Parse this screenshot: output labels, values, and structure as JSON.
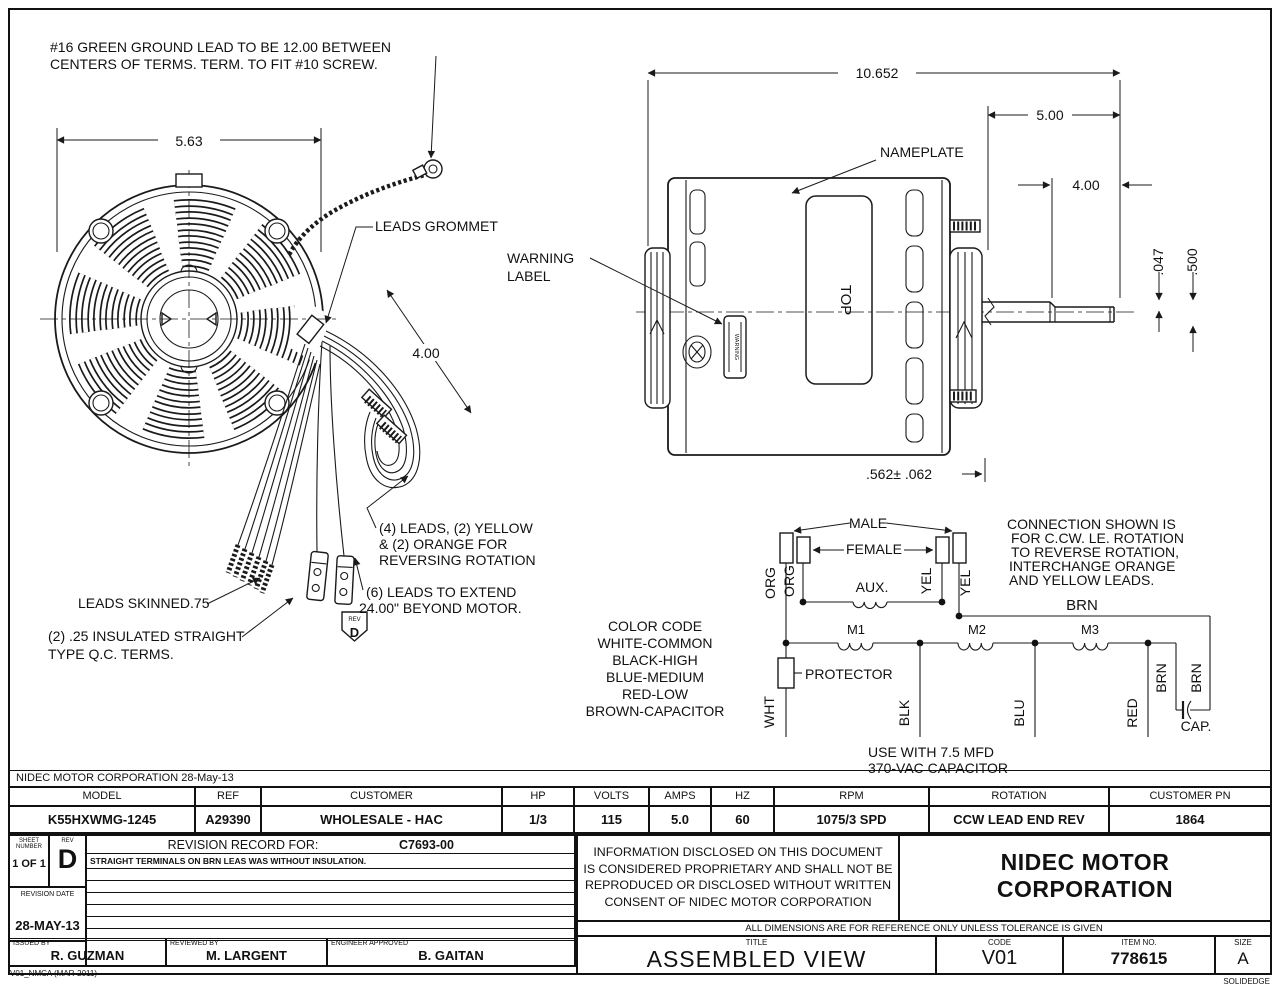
{
  "colors": {
    "line": "#1a1a1a",
    "background": "#ffffff"
  },
  "header_note": "NIDEC MOTOR CORPORATION 28-May-13",
  "footer": {
    "left": "V01_NMCA (MAR-2011)",
    "right": "SOLIDEDGE"
  },
  "drawing": {
    "notes": {
      "ground1": "#16 GREEN GROUND LEAD TO BE 12.00 BETWEEN",
      "ground2": "CENTERS OF TERMS.  TERM. TO FIT #10 SCREW.",
      "leads_grommet": "LEADS GROMMET",
      "warning1": "WARNING",
      "warning2": "LABEL",
      "warning_tag": "WARNING",
      "nameplate": "NAMEPLATE",
      "top_marking": "TOP",
      "leads4_1": "(4) LEADS, (2) YELLOW",
      "leads4_2": "& (2) ORANGE FOR",
      "leads4_3": "REVERSING ROTATION",
      "leads6_1": "(6) LEADS TO EXTEND",
      "leads6_2": "24.00\" BEYOND MOTOR.",
      "skinned": "LEADS SKINNED.75",
      "qc1": "(2) .25 INSULATED STRAIGHT",
      "qc2": "TYPE Q.C. TERMS.",
      "rev_small": "REV",
      "rev_big": "D"
    },
    "dims": {
      "front_width": "5.63",
      "lead_length": "4.00",
      "overall_length": "10.652",
      "shaft_ext": "5.00",
      "flat_length": "4.00",
      "flat_depth": ".047",
      "shaft_dia": ".500",
      "hub_width": ".562± .062"
    },
    "schematic": {
      "male": "MALE",
      "female": "FEMALE",
      "aux": "AUX.",
      "org": "ORG",
      "yel": "YEL",
      "brn": "BRN",
      "wht": "WHT",
      "blk": "BLK",
      "blu": "BLU",
      "red": "RED",
      "cap": "CAP.",
      "m1": "M1",
      "m2": "M2",
      "m3": "M3",
      "protector": "PROTECTOR",
      "conn_note": [
        "CONNECTION SHOWN IS",
        "FOR C.CW. LE. ROTATION",
        "TO REVERSE ROTATION,",
        "INTERCHANGE ORANGE",
        "AND YELLOW LEADS."
      ],
      "cap_note1": "USE WITH 7.5 MFD",
      "cap_note2": "370-VAC CAPACITOR",
      "color_code": [
        "COLOR CODE",
        "WHITE-COMMON",
        "BLACK-HIGH",
        "BLUE-MEDIUM",
        "RED-LOW",
        "BROWN-CAPACITOR"
      ]
    }
  },
  "title_block": {
    "columns": [
      {
        "label": "MODEL",
        "value": "K55HXWMG-1245"
      },
      {
        "label": "REF",
        "value": "A29390"
      },
      {
        "label": "CUSTOMER",
        "value": "WHOLESALE - HAC"
      },
      {
        "label": "HP",
        "value": "1/3"
      },
      {
        "label": "VOLTS",
        "value": "115"
      },
      {
        "label": "AMPS",
        "value": "5.0"
      },
      {
        "label": "HZ",
        "value": "60"
      },
      {
        "label": "RPM",
        "value": "1075/3 SPD"
      },
      {
        "label": "ROTATION",
        "value": "CCW LEAD END REV"
      },
      {
        "label": "CUSTOMER PN",
        "value": "1864"
      }
    ],
    "sheet": {
      "label1": "SHEET",
      "label2": "NUMBER",
      "value": "1 OF 1"
    },
    "rev": {
      "label": "REV",
      "value": "D"
    },
    "revision_record": {
      "label": "REVISION RECORD FOR:",
      "code": "C7693-00",
      "note": "STRAIGHT TERMINALS ON BRN LEAS WAS WITHOUT INSULATION."
    },
    "revision_date": {
      "label": "REVISION DATE",
      "value": "28-MAY-13"
    },
    "signatures": [
      {
        "label": "ISSUED BY",
        "value": "R. GUZMAN"
      },
      {
        "label": "REVIEWED BY",
        "value": "M. LARGENT"
      },
      {
        "label": "ENGINEER APPROVED",
        "value": "B. GAITAN"
      }
    ],
    "proprietary": [
      "INFORMATION DISCLOSED ON THIS DOCUMENT",
      "IS CONSIDERED PROPRIETARY AND SHALL NOT BE",
      "REPRODUCED OR DISCLOSED WITHOUT WRITTEN",
      "CONSENT OF NIDEC MOTOR CORPORATION"
    ],
    "company_line1": "NIDEC MOTOR",
    "company_line2": "CORPORATION",
    "tolerance_note": "ALL DIMENSIONS ARE FOR REFERENCE ONLY UNLESS TOLERANCE IS GIVEN",
    "title": {
      "label": "TITLE",
      "value": "ASSEMBLED VIEW"
    },
    "code": {
      "label": "CODE",
      "value": "V01"
    },
    "item": {
      "label": "ITEM NO.",
      "value": "778615"
    },
    "size": {
      "label": "SIZE",
      "value": "A"
    }
  }
}
